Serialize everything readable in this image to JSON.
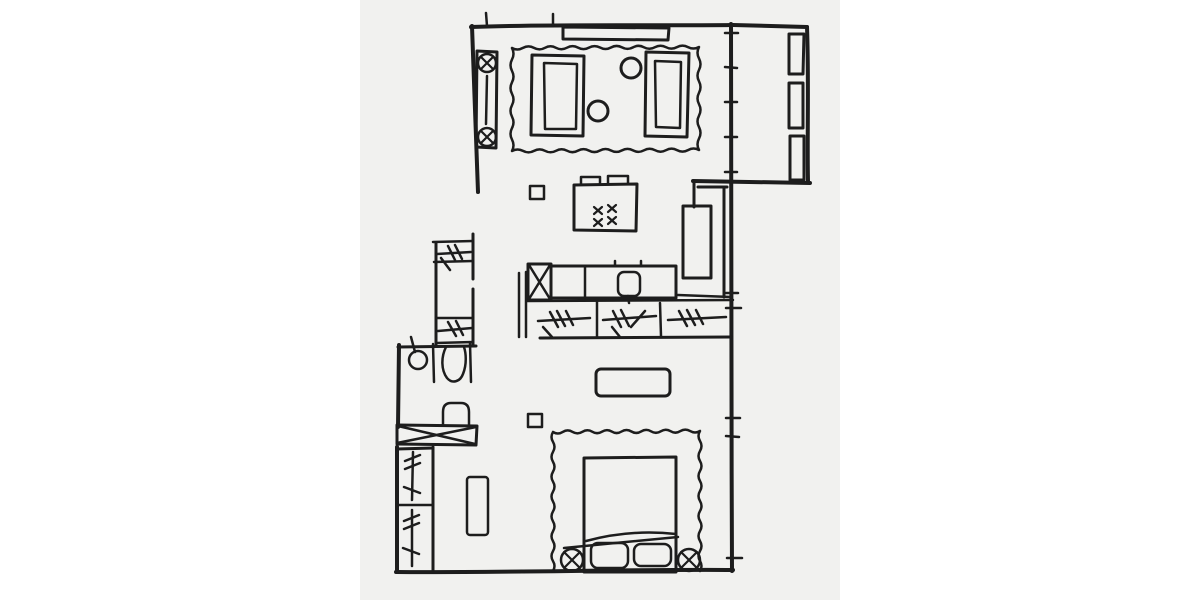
{
  "canvas": {
    "width": 1200,
    "height": 600
  },
  "colors": {
    "page_bg": "#ffffff",
    "panel_bg": "#f1f1ef",
    "ink": "#1d1d1d"
  },
  "diagram": {
    "type": "floor-plan",
    "style": "hand-drawn black ink sketch of an apartment plan on a light gray panel, no text labels",
    "rooms": [
      "living-room",
      "kitchen",
      "hallway-closets",
      "bathroom",
      "bedroom",
      "balcony"
    ],
    "furniture": {
      "living_room": [
        "area-rug-squiggle-border",
        "sofa-left",
        "sofa-right",
        "round-side-table-1",
        "round-side-table-2",
        "tv-console-on-top-wall",
        "radiator-panel-with-two-valve-circles"
      ],
      "kitchen": [
        "island-with-four-burner-x-marks",
        "two-stool-bumps",
        "counter-with-sink-and-tap",
        "crossed-box-appliance",
        "fridge-cabinet",
        "small-wall-square"
      ],
      "closet_row": [
        "three-section-wardrobe-strip-with-hanger-hatch-marks"
      ],
      "hallway": [
        "closet-box-upper-with-hanger-hatches",
        "closet-box-lower-with-hanger-hatches"
      ],
      "bathroom": [
        "round-basin-with-faucet-line",
        "toilet-bowl",
        "arched-fixture",
        "crossed-box-bathtub"
      ],
      "bedroom": [
        "double-bed-with-two-pillows",
        "area-rug-squiggle-border",
        "crossed-circle-lamp-left",
        "crossed-circle-lamp-right",
        "dresser-bench",
        "narrow-bench",
        "two-section-wardrobe-column-with-hanger-hatches",
        "small-wall-square"
      ],
      "balcony": [
        "planter-1",
        "planter-2",
        "planter-3",
        "window-wall-tick-marks"
      ]
    }
  }
}
